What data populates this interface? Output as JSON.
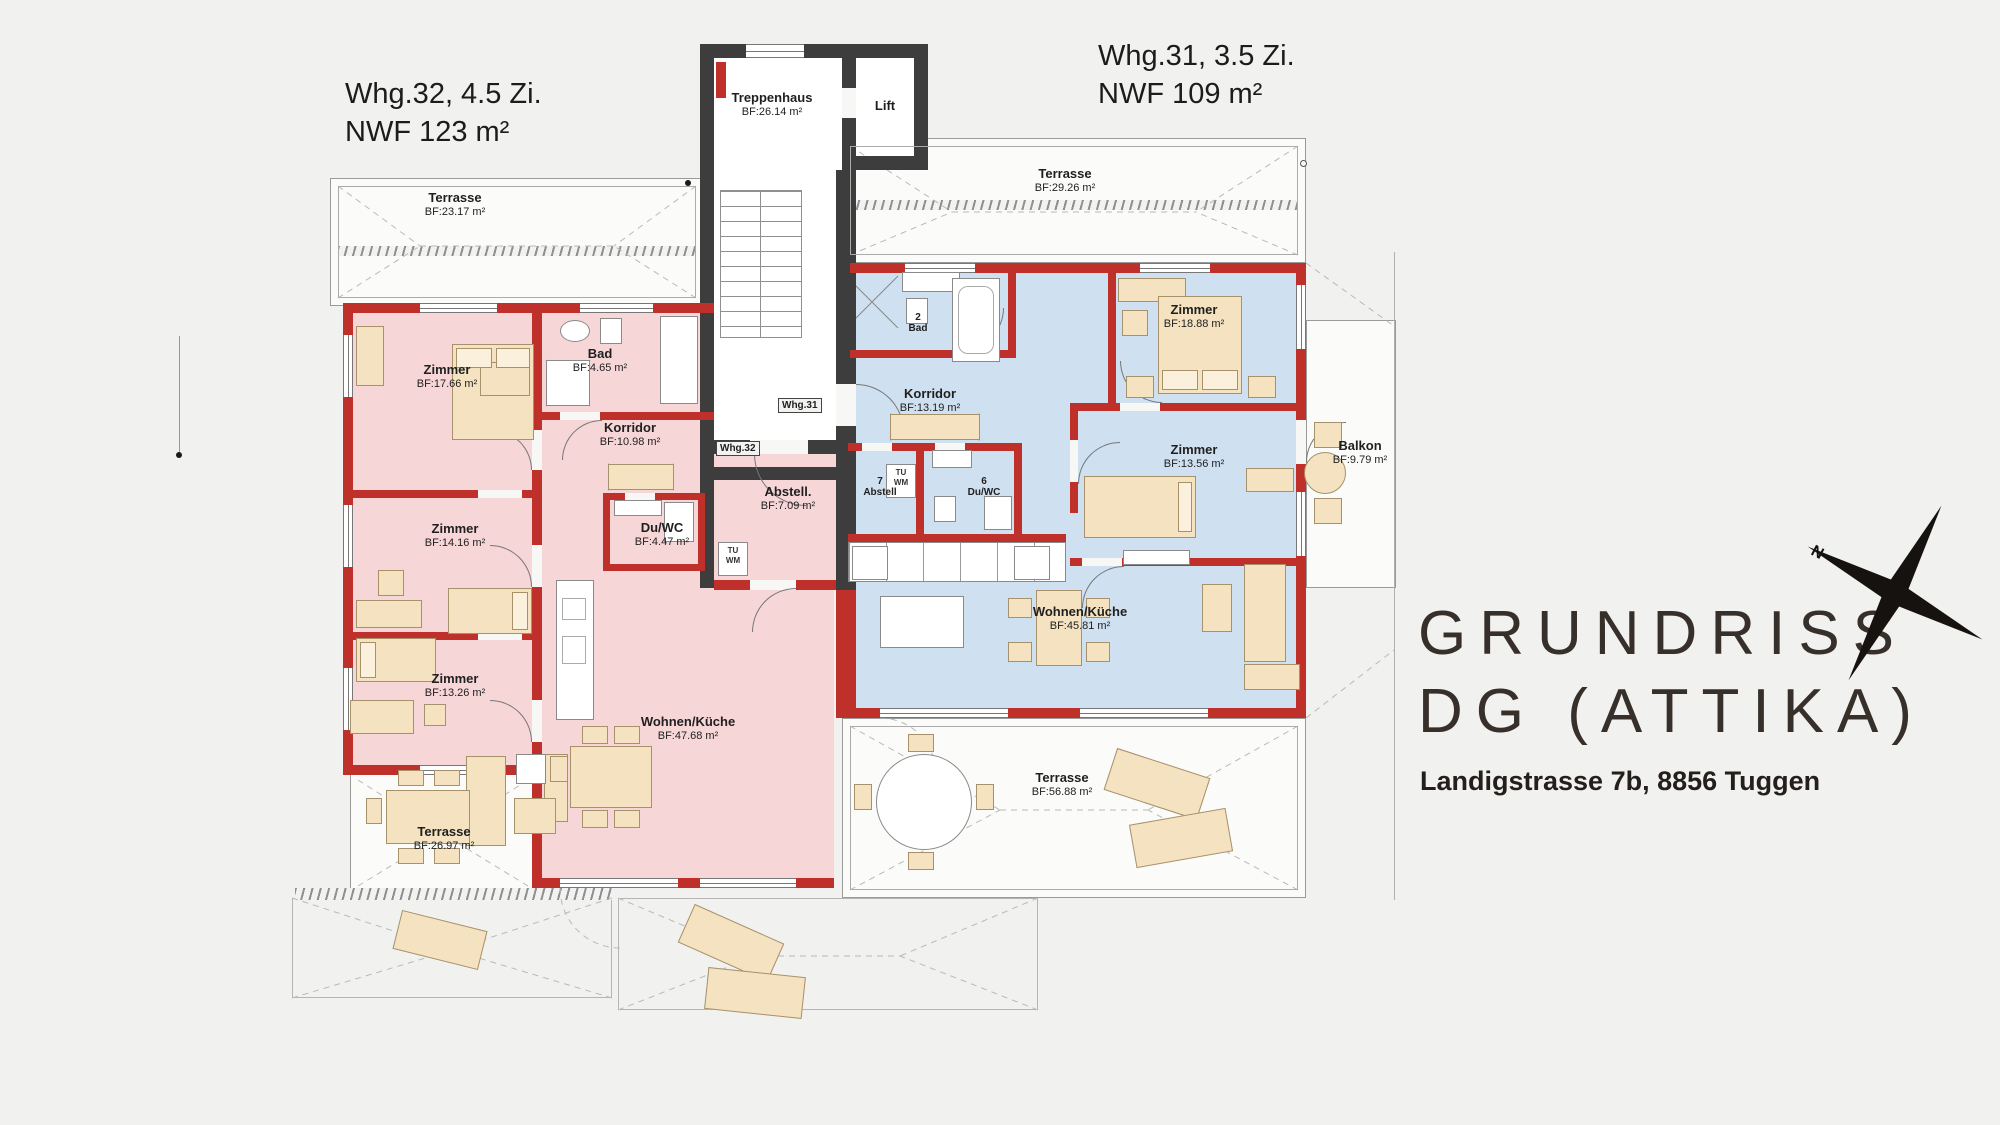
{
  "header_left": {
    "line1": "Whg.32, 4.5 Zi.",
    "line2": "NWF 123 m²"
  },
  "header_right": {
    "line1": "Whg.31, 3.5 Zi.",
    "line2": "NWF 109 m²"
  },
  "brand": {
    "title1": "GRUNDRISS",
    "title2": "DG (ATTIKA)",
    "address": "Landigstrasse 7b, 8856 Tuggen"
  },
  "compass": {
    "north": "N"
  },
  "core": {
    "stair": {
      "name": "Treppenhaus",
      "area": "BF:26.14 m²"
    },
    "lift": "Lift",
    "door_whg31": "Whg.31",
    "door_whg32": "Whg.32"
  },
  "appliances": {
    "tu": "TU",
    "wm": "WM"
  },
  "whg32": {
    "terrace_top": {
      "name": "Terrasse",
      "area": "BF:23.17 m²"
    },
    "terrace_bottom": {
      "name": "Terrasse",
      "area": "BF:26.97 m²"
    },
    "rooms": [
      {
        "name": "Zimmer",
        "area": "BF:17.66 m²"
      },
      {
        "name": "Bad",
        "area": "BF:4.65 m²"
      },
      {
        "name": "Korridor",
        "area": "BF:10.98 m²"
      },
      {
        "name": "Zimmer",
        "area": "BF:14.16 m²"
      },
      {
        "name": "Du/WC",
        "area": "BF:4.47 m²"
      },
      {
        "name": "Abstell.",
        "area": "BF:7.09 m²"
      },
      {
        "name": "Zimmer",
        "area": "BF:13.26 m²"
      },
      {
        "name": "Wohnen/Küche",
        "area": "BF:47.68 m²"
      }
    ]
  },
  "whg31": {
    "terrace_top": {
      "name": "Terrasse",
      "area": "BF:29.26 m²"
    },
    "terrace_bottom": {
      "name": "Terrasse",
      "area": "BF:56.88 m²"
    },
    "balcony": {
      "name": "Balkon",
      "area": "BF:9.79 m²"
    },
    "rooms": [
      {
        "num": "2",
        "name": "Bad",
        "area": ""
      },
      {
        "name": "Zimmer",
        "area": "BF:18.88 m²"
      },
      {
        "name": "Korridor",
        "area": "BF:13.19 m²"
      },
      {
        "name": "Zimmer",
        "area": "BF:13.56 m²"
      },
      {
        "num": "7",
        "name": "Abstell",
        "area": ""
      },
      {
        "num": "6",
        "name": "Du/WC",
        "area": ""
      },
      {
        "name": "Wohnen/Küche",
        "area": "BF:45.81 m²"
      }
    ]
  },
  "colors": {
    "whg32_fill": "#f7d6d8",
    "whg31_fill": "#cfe0f0",
    "wall_red": "#c0302b",
    "wall_dark": "#3e3d3d"
  }
}
